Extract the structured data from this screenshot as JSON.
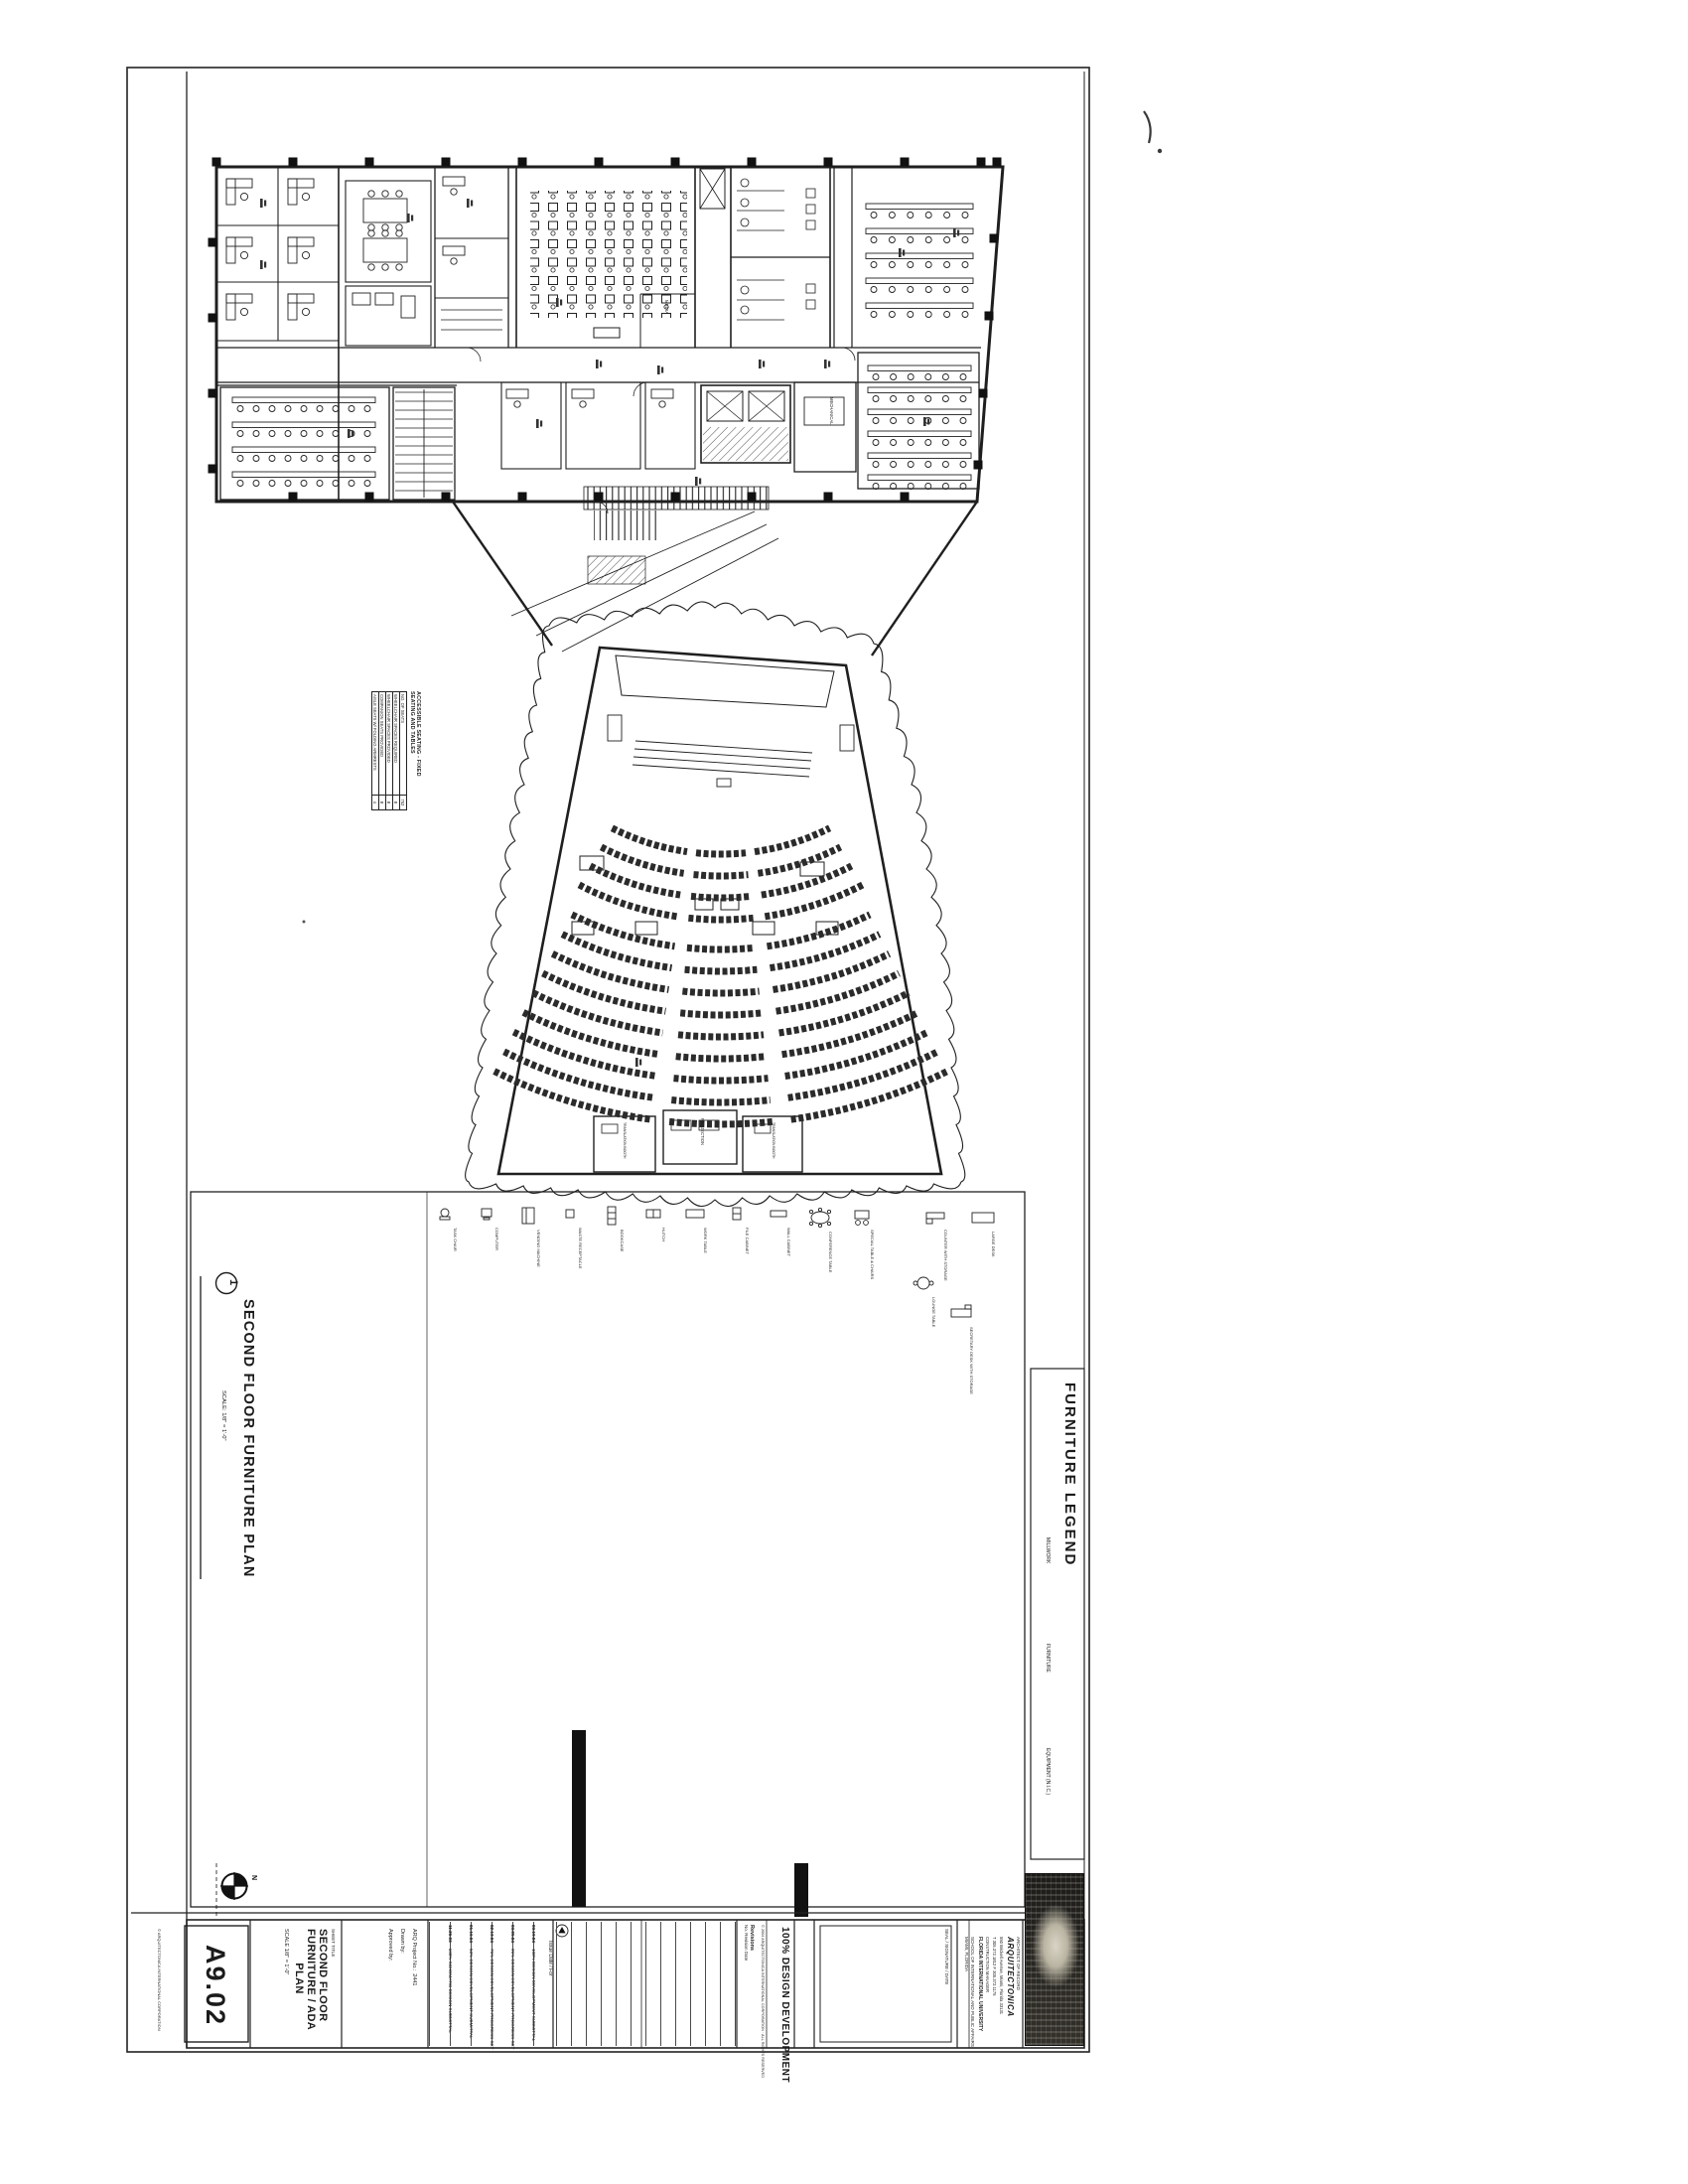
{
  "sheet": {
    "number": "A9.02",
    "sheet_title_label": "SHEET TITLE",
    "title_lines": [
      "SECOND FLOOR",
      "FURNITURE / ADA",
      "PLAN"
    ],
    "title_scale": "SCALE 1/8\" = 1'-0\"",
    "project_no_label": "ARQ Project No.:",
    "project_no": "2441",
    "drawn_by_label": "Drawn by:",
    "approved_by_label": "Approved by:",
    "issue_header": "Issue Date / For",
    "revisions_label": "Revisions",
    "revision_columns": "No.   Revision   Date",
    "submission": "100% DESIGN DEVELOPMENT",
    "copyright": "© 2004 ARQUITECTONICA INTERNATIONAL CORPORATION · ALL RIGHTS RESERVED",
    "edge_note": "© ARQUITECTONICA INTERNATIONAL CORPORATION",
    "seal_label": "SEAL / SIGNATURE / DATE",
    "north_label": "N"
  },
  "issues": [
    {
      "date": "11.26.03",
      "label": "100% SCHEMATIC DESIGN SUBMITTAL"
    },
    {
      "date": "01.16.04",
      "label": "50% DESIGN DEVELOPMENT SUBMITTAL"
    },
    {
      "date": "02.13.04",
      "label": "75% DESIGN DEVELOPMENT PROGRESS SET"
    },
    {
      "date": "03.05.04",
      "label": "95% DESIGN DEVELOPMENT PROGRESS SET"
    },
    {
      "date": "03.19.04",
      "label": "100% DESIGN DEVELOPMENT SUBMITTAL"
    }
  ],
  "architect": {
    "role": "ARCHITECT OF RECORD",
    "name": "ARQUITECTONICA",
    "address": "550 Brickell Avenue, Miami, Florida 33131",
    "phone": "T 305.372.1812   F 305.372.1175",
    "cm_label": "CONSTRUCTION MANAGER"
  },
  "project": {
    "owner": "FLORIDA INTERNATIONAL UNIVERSITY",
    "name": "SCHOOL OF INTERNATIONAL AND PUBLIC AFFAIRS",
    "location": "MIAMI, FLORIDA"
  },
  "plan": {
    "detail_number": "1",
    "title": "SECOND FLOOR FURNITURE PLAN",
    "scale": "SCALE:   1/8\" = 1'-0\"",
    "rooms": [
      {
        "label": "MEDIA"
      },
      {
        "label": "MECHANICAL"
      },
      {
        "label": "PROJECTION"
      },
      {
        "label": "TRANSLATION BOOTH"
      },
      {
        "label": "TRANSLATION BOOTH"
      }
    ]
  },
  "ada_table": {
    "title_lines": [
      "ACCESSIBLE SEATING - FIXED",
      "SEATING AND TABLES"
    ],
    "rows": [
      [
        "NO. OF SEATS",
        "752"
      ],
      [
        "WHEELCHAIR SPACES REQUIRED",
        "8"
      ],
      [
        "WHEELCHAIR SPACES PROVIDED",
        "8"
      ],
      [
        "COMPANION SEATS PROVIDED",
        "8"
      ],
      [
        "AISLE SEATS W/ FOLDING ARMRESTS",
        "4"
      ]
    ]
  },
  "legend": {
    "title": "FURNITURE LEGEND",
    "categories": [
      "MILLWORK",
      "FURNITURE",
      "EQUIPMENT (N.I.C.)"
    ],
    "items": [
      {
        "label": "TASK CHAIR",
        "sym": "chair"
      },
      {
        "label": "COMPUTER",
        "sym": "computer"
      },
      {
        "label": "VENDING MACHINE",
        "sym": "vending"
      },
      {
        "label": "WASTE RECEPTACLE",
        "sym": "waste"
      },
      {
        "label": "BOOKCASE",
        "sym": "bookcase"
      },
      {
        "label": "HUTCH",
        "sym": "hutch"
      },
      {
        "label": "WORK TABLE",
        "sym": "table"
      },
      {
        "label": "FILE CABINET",
        "sym": "file"
      },
      {
        "label": "WALL CABINET",
        "sym": "wallcab"
      },
      {
        "label": "CONFERENCE TABLE",
        "sym": "conf"
      },
      {
        "label": "SPECIAL TABLE & CHAIRS",
        "sym": "special"
      },
      {
        "label": "COUNTER WITH STORAGE",
        "sym": "counter"
      },
      {
        "label": "LARGE DESK",
        "sym": "desk"
      },
      {
        "label": "LOUNGE TABLE",
        "sym": "lounge"
      },
      {
        "label": "SECRETARY DESK WITH STORAGE",
        "sym": "secretary"
      }
    ]
  }
}
